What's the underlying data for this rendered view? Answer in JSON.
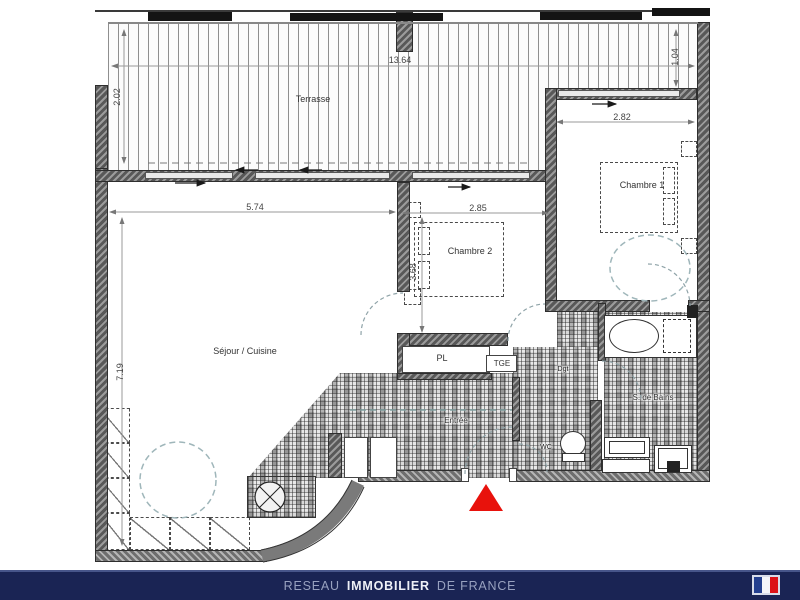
{
  "labels": {
    "terrasse": "Terrasse",
    "sejour": "Séjour / Cuisine",
    "chambre1": "Chambre 1",
    "chambre2": "Chambre 2",
    "pl": "PL",
    "tge": "TGE",
    "dgt": "Dgt",
    "wc": "WC",
    "bains": "S. de Bains",
    "entree": "Entrée"
  },
  "dims": {
    "total_width": "13.64",
    "terrasse_depth": "2.02",
    "right_depth": "1.04",
    "sejour_width": "5.74",
    "sejour_height": "7.19",
    "chambre2_width": "2.85",
    "chambre2_height": "3.68",
    "chambre1_width": "2.82"
  },
  "footer": {
    "pre": "RESEAU",
    "bold": "IMMOBILIER",
    "post": "DE FRANCE"
  },
  "colors": {
    "entrance_marker": "#e8120c",
    "footer_bar": "#1a2454",
    "flag_blue": "#243f8f",
    "flag_white": "#f4f5f9",
    "flag_red": "#dc1218"
  }
}
